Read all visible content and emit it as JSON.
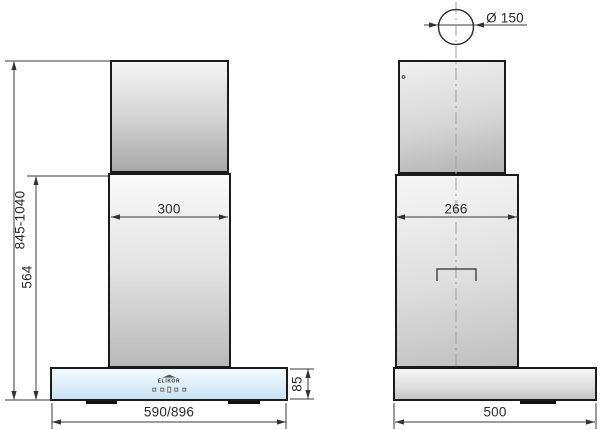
{
  "drawing": {
    "subject": "wall-mounted chimney hood dimensional drawing, front and side views",
    "front_view": {
      "overall_height_label": "845-1040",
      "body_height_label": "564",
      "duct_width_label": "300",
      "panel_height_label": "85",
      "overall_width_label": "590/896",
      "panel_logo": "ELIKOR",
      "control_buttons_count": "5"
    },
    "side_view": {
      "flue_diameter_label": "Ø 150",
      "upper_body_depth_label": "266",
      "hood_depth_label": "500"
    },
    "colors": {
      "glass_panel_blue": "#d9ebf7",
      "steel_gray": "#c0c0c0",
      "line_color": "#333333"
    }
  }
}
